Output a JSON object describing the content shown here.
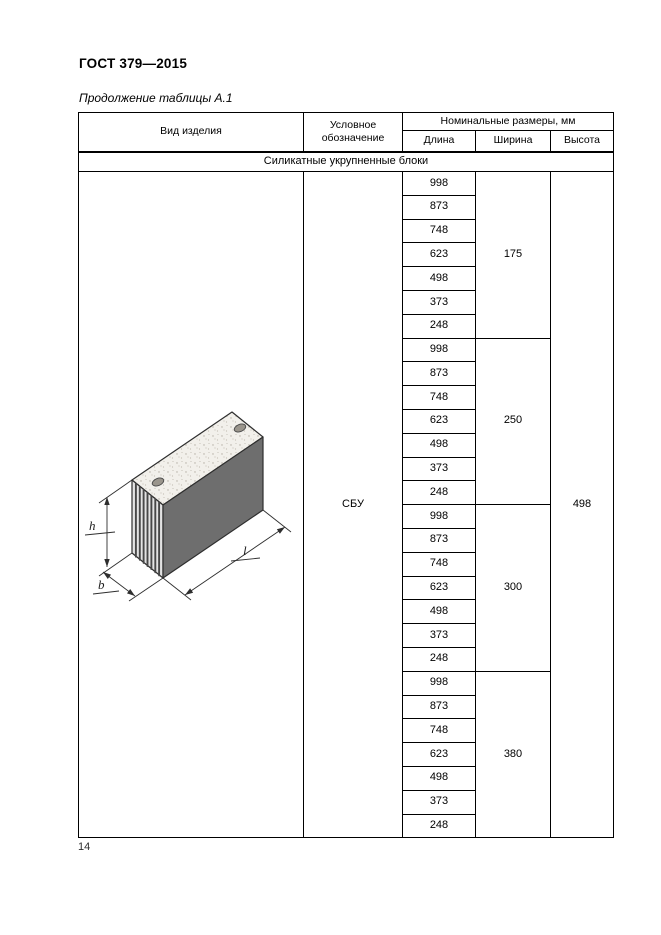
{
  "header": {
    "title": "ГОСТ 379—2015",
    "table_caption": "Продолжение таблицы А.1"
  },
  "table": {
    "columns": {
      "product_type": "Вид изделия",
      "designation": "Условное обозначение",
      "dimensions_group": "Номинальные размеры, мм",
      "length": "Длина",
      "width": "Ширина",
      "height": "Высота"
    },
    "section_title": "Силикатные укрупненные блоки",
    "designation_value": "СБУ",
    "height_value": "498",
    "groups": [
      {
        "width": "175",
        "lengths": [
          "998",
          "873",
          "748",
          "623",
          "498",
          "373",
          "248"
        ]
      },
      {
        "width": "250",
        "lengths": [
          "998",
          "873",
          "748",
          "623",
          "498",
          "373",
          "248"
        ]
      },
      {
        "width": "300",
        "lengths": [
          "998",
          "873",
          "748",
          "623",
          "498",
          "373",
          "248"
        ]
      },
      {
        "width": "380",
        "lengths": [
          "998",
          "873",
          "748",
          "623",
          "498",
          "373",
          "248"
        ]
      }
    ],
    "drawing_labels": {
      "height": "h",
      "width": "b",
      "length": "l"
    }
  },
  "footer": {
    "page_number": "14"
  },
  "colors": {
    "border": "#000000",
    "front_face": "#6e6e6e",
    "top_face": "#f2f0eb"
  }
}
